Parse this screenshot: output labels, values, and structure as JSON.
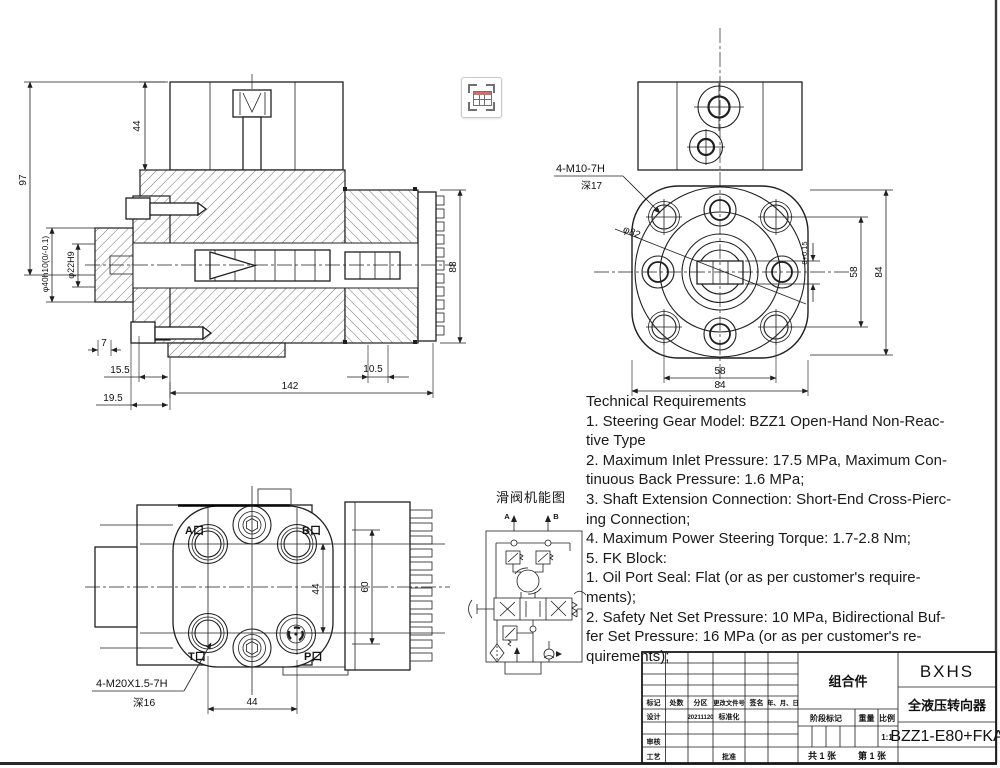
{
  "sheet": {
    "background": "#ffffff",
    "line_color": "#1f1f1f",
    "frame_color": "#3c3c3c"
  },
  "overlay_icon": {
    "name": "table-capture-icon",
    "accent": "#d96a6a",
    "gray": "#707070"
  },
  "section_view": {
    "dims": {
      "height_97": "97",
      "dia_40": "φ40h10(0/-0.1)",
      "dia_22": "φ22H9",
      "top_44": "44",
      "right_88": "88",
      "d7": "7",
      "d15_5": "15.5",
      "d19_5": "19.5",
      "d142": "142",
      "d10_5": "10.5"
    }
  },
  "front_view": {
    "labels": {
      "thread": "4-M10-7H",
      "thread_depth": "深17",
      "dia_82": "φ82",
      "slot_8": "8+0.15",
      "right_58": "58",
      "right_84": "84",
      "bottom_58": "58",
      "bottom_84": "84"
    }
  },
  "port_view": {
    "labels": {
      "port_a": "A口",
      "port_b": "B口",
      "port_t": "T口",
      "port_p": "P口",
      "bottom_44": "44",
      "right_44": "44",
      "side_60": "60",
      "thread": "4-M20X1.5-7H",
      "thread_depth": "深16"
    }
  },
  "schematic": {
    "title": "滑阀机能图",
    "port_a": "A",
    "port_b": "B"
  },
  "tech_requirements": {
    "lines": [
      "Technical Requirements",
      "1. Steering Gear Model: BZZ1 Open-Hand Non-Reac-",
      "tive Type",
      "2. Maximum Inlet Pressure: 17.5 MPa, Maximum Con-",
      "tinuous Back Pressure: 1.6 MPa;",
      "3. Shaft Extension Connection: Short-End Cross-Pierc-",
      "ing Connection;",
      "4. Maximum Power Steering Torque: 1.7-2.8 Nm;",
      "5. FK Block:",
      "1. Oil Port Seal: Flat (or as per customer's require-",
      "ments);",
      "2. Safety Net Set Pressure: 10 MPa, Bidirectional Buf-",
      "fer Set Pressure: 16 MPa (or as per customer's re-",
      "quirements);"
    ]
  },
  "title_block": {
    "assembly": "组合件",
    "company": "BXHS",
    "product": "全液压转向器",
    "model": "BZZ1-E80+FKA",
    "col_headers": [
      "标记",
      "处数",
      "分区",
      "更改文件号",
      "签名",
      "年、月、日"
    ],
    "row_design": "设计",
    "design_date": "20211120",
    "row_std": "标准化",
    "row_check": "审核",
    "row_process": "工艺",
    "row_approve": "批准",
    "stage_mark": "阶段标记",
    "weight": "重量",
    "scale": "比例",
    "scale_value": "1:1",
    "total_sheets": "共 1 张",
    "sheet_number": "第 1 张"
  }
}
